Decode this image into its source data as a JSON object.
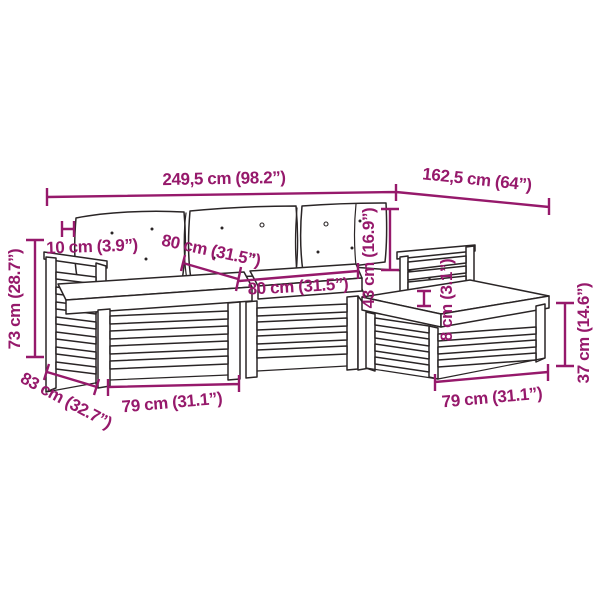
{
  "title": "Garden pallet lounge set — dimension diagram",
  "colors": {
    "background": "#ffffff",
    "dimension": "#96196b",
    "artwork": "#2a2526"
  },
  "dims": {
    "total_length": {
      "label": "249,5 cm (98.2”)",
      "cm": "249,5",
      "inches": "98.2"
    },
    "right_section_length": {
      "label": "162,5 cm (64”)",
      "cm": "162,5",
      "inches": "64"
    },
    "overall_height": {
      "label": "73 cm (28.7”)",
      "cm": "73",
      "inches": "28.7"
    },
    "armrest_thickness": {
      "label": "10 cm (3.9”)",
      "cm": "10",
      "inches": "3.9"
    },
    "back_cushion_width": {
      "label": "80 cm (31.5”)",
      "cm": "80",
      "inches": "31.5"
    },
    "seat_width": {
      "label": "80 cm (31.5”)",
      "cm": "80",
      "inches": "31.5"
    },
    "backrest_height": {
      "label": "43 cm (16.9”)",
      "cm": "43",
      "inches": "16.9"
    },
    "cushion_thickness": {
      "label": "8 cm (3.1”)",
      "cm": "8",
      "inches": "3.1"
    },
    "footstool_height": {
      "label": "37 cm (14.6”)",
      "cm": "37",
      "inches": "14.6"
    },
    "seat_module_width": {
      "label": "79 cm (31.1”)",
      "cm": "79",
      "inches": "31.1"
    },
    "footstool_width": {
      "label": "79 cm (31.1”)",
      "cm": "79",
      "inches": "31.1"
    },
    "module_depth": {
      "label": "83 cm (32.7”)",
      "cm": "83",
      "inches": "32.7"
    }
  }
}
